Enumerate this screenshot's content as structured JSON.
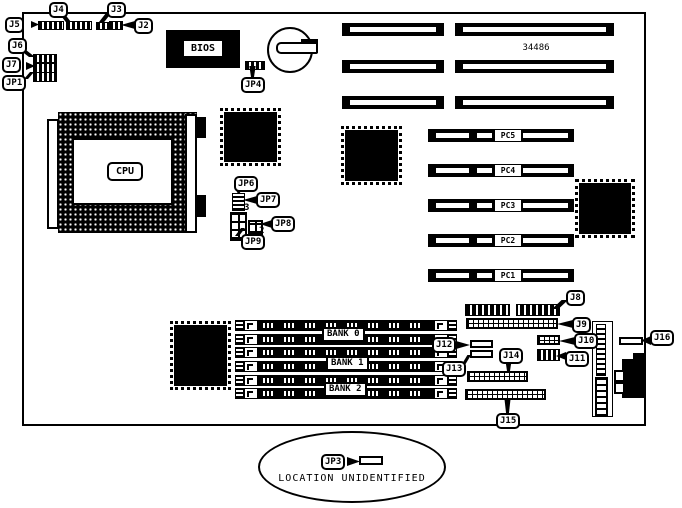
{
  "diagram": {
    "part_number": "34486",
    "cpu": "CPU",
    "bios": "BIOS",
    "note_text": "LOCATION UNIDENTIFIED"
  },
  "callouts": {
    "j2": "J2",
    "j3": "J3",
    "j4": "J4",
    "j5": "J5",
    "j6": "J6",
    "j7": "J7",
    "j8": "J8",
    "j9": "J9",
    "j10": "J10",
    "j11": "J11",
    "j12": "J12",
    "j13": "J13",
    "j14": "J14",
    "j15": "J15",
    "j16": "J16",
    "jp1": "JP1",
    "jp3": "JP3",
    "jp4": "JP4",
    "jp6": "JP6",
    "jp7": "JP7",
    "jp8": "JP8",
    "jp9": "JP9"
  },
  "pc_slots": [
    "PC5",
    "PC4",
    "PC3",
    "PC2",
    "PC1"
  ],
  "memory_banks": [
    "BANK 0",
    "BANK 1",
    "BANK 2"
  ],
  "pin_numbers": {
    "jp7": "3",
    "jp8": "2"
  }
}
